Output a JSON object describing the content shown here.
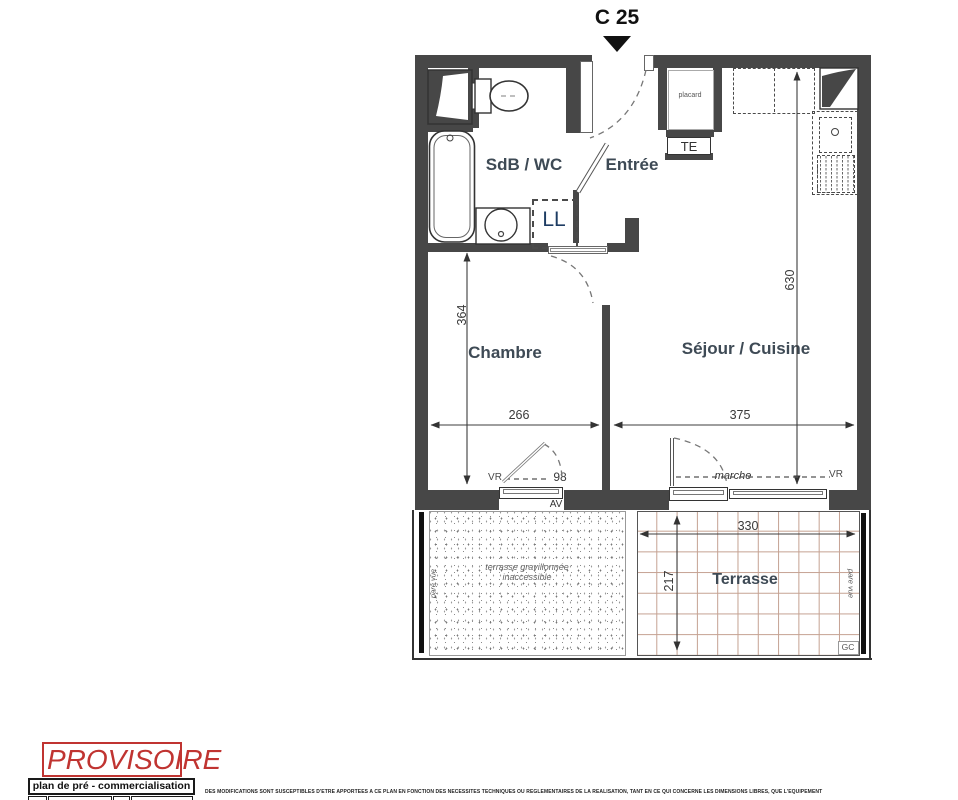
{
  "unit_label": "C 25",
  "rooms": {
    "sdb_wc": "SdB / WC",
    "entree": "Entrée",
    "chambre": "Chambre",
    "sejour_cuisine": "Séjour / Cuisine",
    "terrasse": "Terrasse",
    "terrasse_gravillonnee_line1": "terrasse gravillonnée",
    "terrasse_gravillonnee_line2": "inaccessible"
  },
  "fixtures": {
    "placard": "placard",
    "te": "TE",
    "ll": "LL"
  },
  "dimensions": {
    "chambre_depth": "364",
    "sejour_depth": "630",
    "chambre_width": "266",
    "sejour_width": "375",
    "terrasse_width": "330",
    "terrasse_depth": "217",
    "fenetre_chambre": "98"
  },
  "annotations": {
    "vr_chambre": "VR",
    "vr_sejour": "VR",
    "av": "AV",
    "marche": "marche",
    "gc": "GC",
    "pare_vue_left": "pare vue",
    "pare_vue_right": "pare vue"
  },
  "stamp": {
    "provisoire": "PROVISOIRE",
    "plan_type": "plan de pré - commercialisation"
  },
  "disclaimer": "DES MODIFICATIONS SONT SUSCEPTIBLES D'ETRE APPORTEES A CE PLAN EN FONCTION DES NECESSITES TECHNIQUES OU REGLEMENTAIRES DE LA REALISATION, TANT EN CE QUI CONCERNE LES DIMENSIONS LIBRES, QUE L'EQUIPEMENT",
  "colors": {
    "wall": "#474747",
    "tile_grid": "#c4a191",
    "stamp_red": "#c03431",
    "room_label": "#3e4a55"
  }
}
